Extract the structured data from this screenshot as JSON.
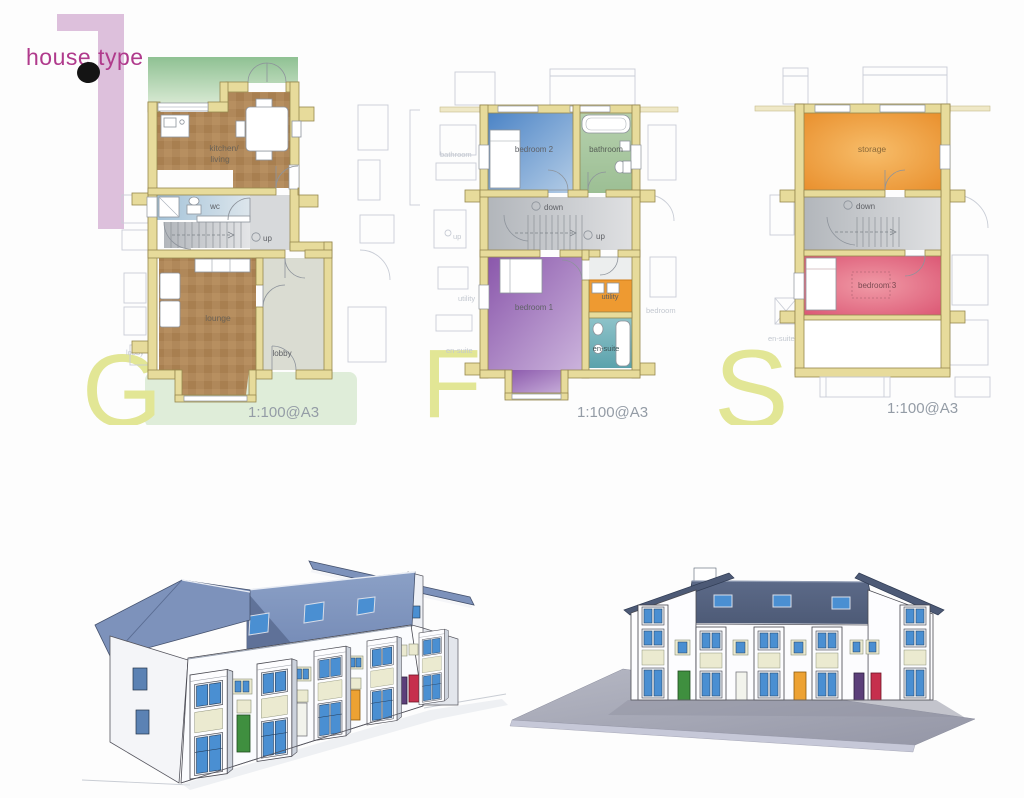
{
  "sheet": {
    "title": "house type",
    "house_type_number": "1"
  },
  "plans": {
    "ground": {
      "letter": "G",
      "scale": "1:100@A3",
      "labels": {
        "kitchen_line1": "kitchen/",
        "kitchen_line2": "living",
        "wc": "wc",
        "up": "up",
        "lounge": "lounge",
        "lobby": "lobby"
      },
      "adjacent_labels": {
        "lobby": "lobby"
      }
    },
    "first": {
      "letter": "F",
      "scale": "1:100@A3",
      "labels": {
        "bedroom2": "bedroom 2",
        "bathroom": "bathroom",
        "down": "down",
        "up": "up",
        "bedroom1": "bedroom 1",
        "utility": "utility",
        "ensuite": "en-suite"
      },
      "adjacent_labels": {
        "bathroom": "bathroom",
        "up": "up",
        "utility": "utility",
        "ensuite": "en-suite",
        "bedroom": "bedroom"
      }
    },
    "second": {
      "letter": "S",
      "scale": "1:100@A3",
      "labels": {
        "storage": "storage",
        "down": "down",
        "bedroom3": "bedroom 3"
      },
      "adjacent_labels": {
        "ensuite": "en-suite"
      }
    }
  },
  "palette": {
    "title_text": "#b03a8c",
    "numeral_pink": "#ddc0dc",
    "plan_letter_olive": "#e2e695",
    "wall_tan": "#e7db9b",
    "garden_green": "#92c295",
    "kitchen_lounge_brown": "#b0885a",
    "wc_blue": "#a3c2d8",
    "stair_grey": "#c6c6c8",
    "lobby_grey": "#dadcd2",
    "bedroom2_blue": "#4c84c6",
    "bathroom_green": "#abc9a4",
    "bedroom1_purple": "#8a57ab",
    "utility_orange": "#ee9a31",
    "ensuite_teal": "#72b2ba",
    "storage_orange": "#e88d2a",
    "bedroom3_pink": "#d94f6e",
    "scale_text_grey": "#949ca6",
    "roof_blue": "#7d92bb",
    "roof_dark": "#4d5a76",
    "window_blue": "#4a8fd2",
    "panel_cream": "#ebead0",
    "door_green": "#3f8f3f",
    "door_orange": "#eda233",
    "door_purple": "#5c3f7a",
    "door_red": "#c62f4d",
    "ground_slab_grey": "#a9abb8"
  }
}
